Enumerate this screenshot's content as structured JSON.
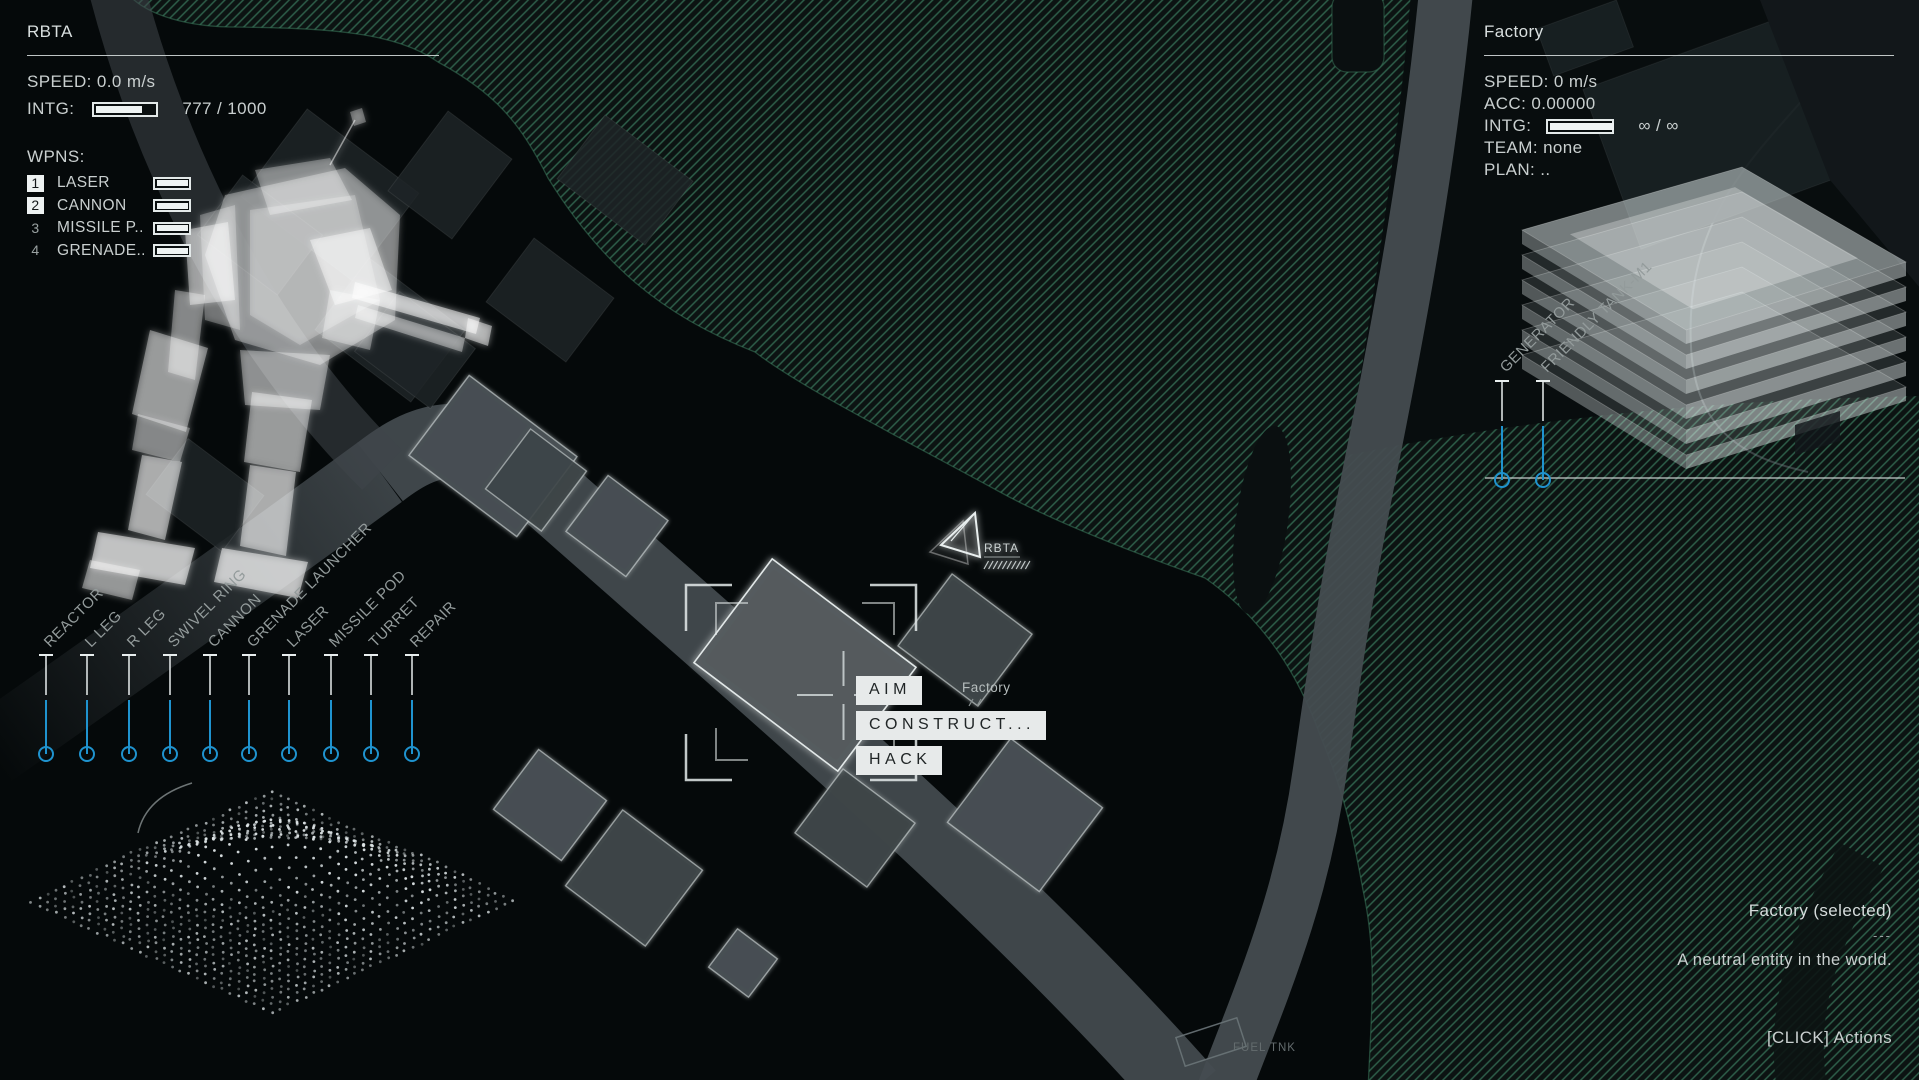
{
  "left_panel": {
    "title": "RBTA",
    "speed_line": "SPEED: 0.0 m/s",
    "intg_label": "INTG:",
    "intg_value": "777 / 1000",
    "wpns_label": "WPNS:",
    "weapons": [
      {
        "slot": "1",
        "name": "LASER",
        "selected": true
      },
      {
        "slot": "2",
        "name": "CANNON",
        "selected": true
      },
      {
        "slot": "3",
        "name": "MISSILE P...",
        "selected": false
      },
      {
        "slot": "4",
        "name": "GRENADE...",
        "selected": false
      }
    ]
  },
  "mech_part_labels": [
    "REACTOR",
    "L LEG",
    "R LEG",
    "SWIVEL RING",
    "CANNON",
    "GRENADE LAUNCHER",
    "LASER",
    "MISSILE POD",
    "TURRET",
    "REPAIR"
  ],
  "unit_marker": {
    "label": "RBTA"
  },
  "selection_menu": {
    "items": [
      "AIM",
      "CONSTRUCT...",
      "HACK"
    ],
    "target_label": "Factory"
  },
  "right_panel": {
    "title": "Factory",
    "speed_line": "SPEED: 0 m/s",
    "acc_line": "ACC: 0.00000",
    "intg_label": "INTG:",
    "intg_value": "∞ / ∞",
    "team_line": "TEAM: none",
    "plan_line": "PLAN: ..",
    "structure_labels": [
      "GENERATOR",
      "FRIENDLY TANK-M1"
    ]
  },
  "info_panel": {
    "title": "Factory (selected)",
    "divider": "---",
    "description": "A neutral entity in the world.",
    "hint": "[CLICK] Actions"
  },
  "map_labels": {
    "fuel_tank": "FUEL TNK"
  },
  "colors": {
    "accent_blue": "#1f93cf",
    "hatch_green": "#2e5f4a",
    "hatch_edge_green": "#3c7a5c",
    "road_gray": "#454c50",
    "building_gray": "#474e52",
    "selected_building_gray": "#545b5e",
    "menu_bg": "#e7eaea",
    "text_light": "#c9cfcf"
  }
}
